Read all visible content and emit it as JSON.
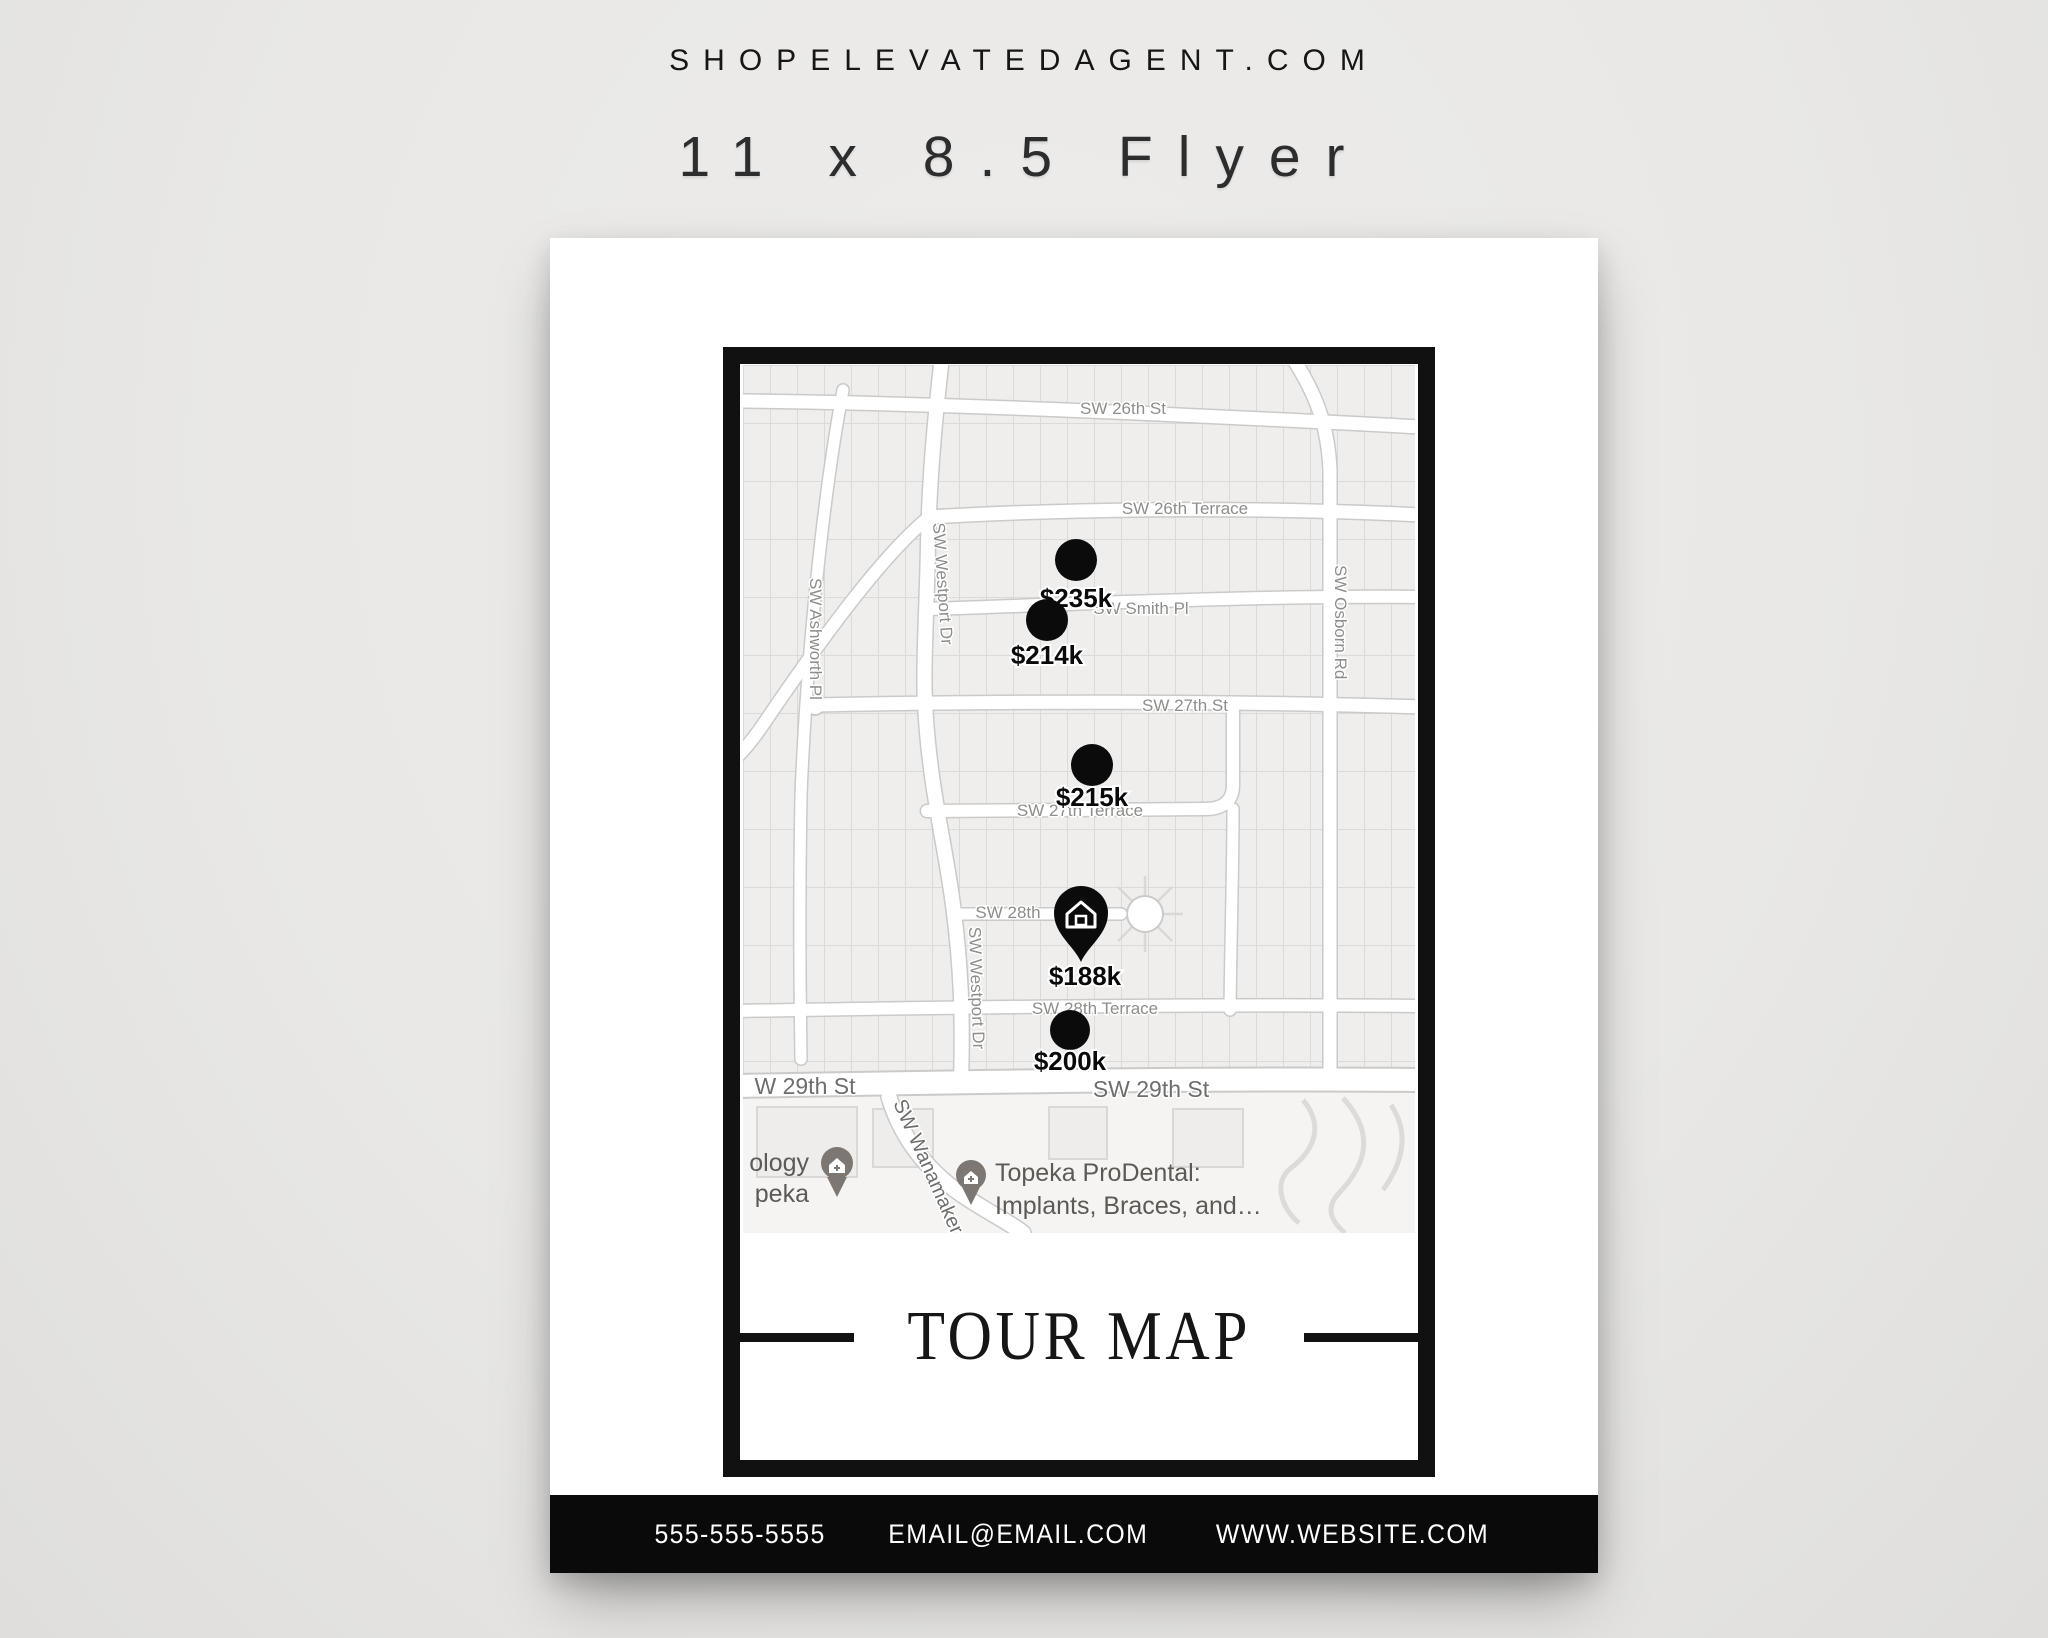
{
  "header": {
    "site_url": "SHOPELEVATEDAGENT.COM",
    "product_title": "11 x 8.5 Flyer"
  },
  "flyer": {
    "map_title": "TOUR MAP",
    "contact": {
      "phone": "555-555-5555",
      "email": "EMAIL@EMAIL.COM",
      "website": "WWW.WEBSITE.COM"
    },
    "map": {
      "streets": {
        "sw26th": "SW 26th St",
        "sw26ter": "SW 26th Terrace",
        "smith": "SW Smith Pl",
        "sw27th": "SW 27th St",
        "sw27ter": "SW 27th Terrace",
        "sw28th": "SW 28th",
        "sw28ter": "SW 28th Terrace",
        "w29_left": "W 29th St",
        "sw29_right": "SW 29th St",
        "westport": "SW Westport Dr",
        "ashworth": "SW Ashworth Pl",
        "osborn": "SW Osborn Rd",
        "wanamaker": "SW Wanamaker"
      },
      "markers": [
        {
          "price": "$235k",
          "type": "dot"
        },
        {
          "price": "$214k",
          "type": "dot"
        },
        {
          "price": "$215k",
          "type": "dot"
        },
        {
          "price": "$188k",
          "type": "home-pin"
        },
        {
          "price": "$200k",
          "type": "dot"
        }
      ],
      "pois": {
        "left_clipped_line1": "ology",
        "left_clipped_line2": "peka",
        "dental_line1": "Topeka ProDental:",
        "dental_line2": "Implants, Braces, and…"
      }
    }
  },
  "colors": {
    "background": "#e9e8e6",
    "page": "#ffffff",
    "frame": "#111111",
    "contact_bar": "#0a0a0a",
    "marker": "#0b0b0b",
    "street_label": "#8e8d8a"
  }
}
